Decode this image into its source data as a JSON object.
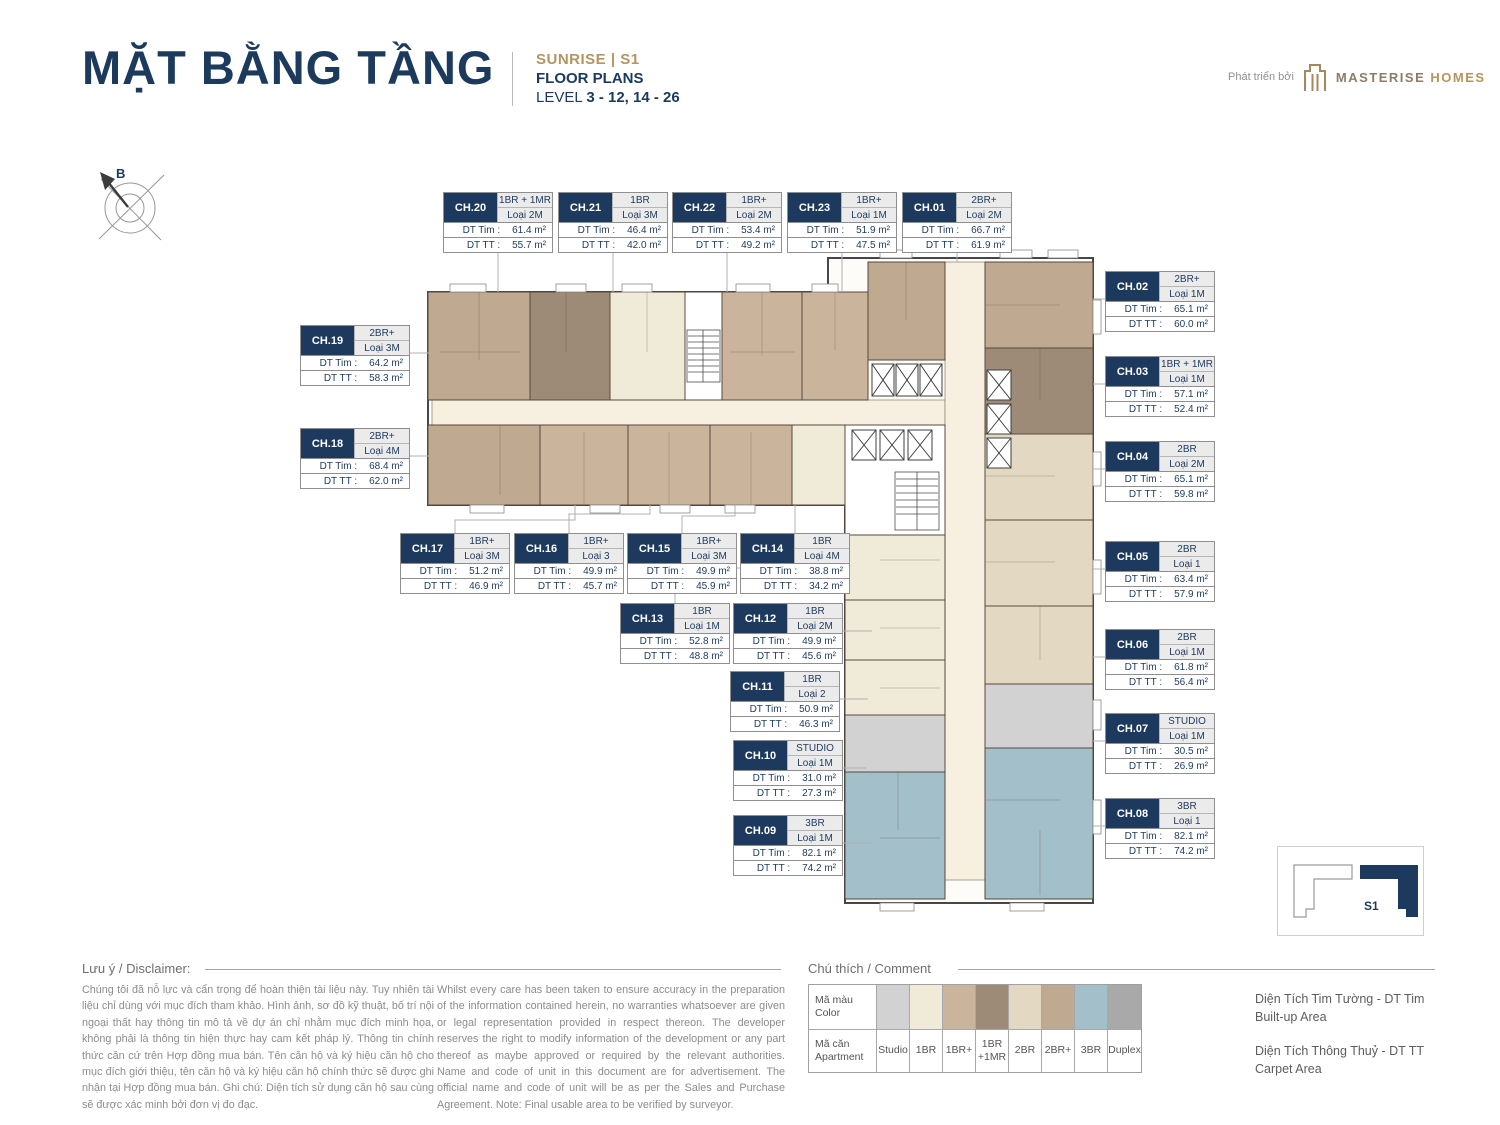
{
  "header": {
    "title": "MẶT BẰNG TẦNG",
    "project": "SUNRISE  |  S1",
    "subtitle": "FLOOR PLANS",
    "level_label": "LEVEL",
    "level_value": "3 - 12, 14 - 26",
    "developer_prefix": "Phát triển bởi",
    "developer_name": "MASTERISE",
    "developer_name2": "HOMES"
  },
  "compass_label": "B",
  "area_labels": {
    "tim": "DT Tim :",
    "tt": "DT TT :"
  },
  "units": [
    {
      "id": "CH.01",
      "type": "2BR+",
      "loai": "Loại 2M",
      "tim": "66.7 m²",
      "tt": "61.9 m²",
      "legend_key": "2BR+"
    },
    {
      "id": "CH.02",
      "type": "2BR+",
      "loai": "Loại 1M",
      "tim": "65.1 m²",
      "tt": "60.0 m²",
      "legend_key": "2BR+"
    },
    {
      "id": "CH.03",
      "type": "1BR + 1MR",
      "loai": "Loại 1M",
      "tim": "57.1 m²",
      "tt": "52.4 m²",
      "legend_key": "1BR +1MR"
    },
    {
      "id": "CH.04",
      "type": "2BR",
      "loai": "Loại 2M",
      "tim": "65.1 m²",
      "tt": "59.8 m²",
      "legend_key": "2BR"
    },
    {
      "id": "CH.05",
      "type": "2BR",
      "loai": "Loại 1",
      "tim": "63.4 m²",
      "tt": "57.9 m²",
      "legend_key": "2BR"
    },
    {
      "id": "CH.06",
      "type": "2BR",
      "loai": "Loại 1M",
      "tim": "61.8 m²",
      "tt": "56.4 m²",
      "legend_key": "2BR"
    },
    {
      "id": "CH.07",
      "type": "STUDIO",
      "loai": "Loại 1M",
      "tim": "30.5 m²",
      "tt": "26.9 m²",
      "legend_key": "Studio"
    },
    {
      "id": "CH.08",
      "type": "3BR",
      "loai": "Loại 1",
      "tim": "82.1 m²",
      "tt": "74.2 m²",
      "legend_key": "3BR"
    },
    {
      "id": "CH.09",
      "type": "3BR",
      "loai": "Loại 1M",
      "tim": "82.1 m²",
      "tt": "74.2 m²",
      "legend_key": "3BR"
    },
    {
      "id": "CH.10",
      "type": "STUDIO",
      "loai": "Loại 1M",
      "tim": "31.0 m²",
      "tt": "27.3 m²",
      "legend_key": "Studio"
    },
    {
      "id": "CH.11",
      "type": "1BR",
      "loai": "Loại 2",
      "tim": "50.9 m²",
      "tt": "46.3 m²",
      "legend_key": "1BR"
    },
    {
      "id": "CH.12",
      "type": "1BR",
      "loai": "Loại 2M",
      "tim": "49.9 m²",
      "tt": "45.6 m²",
      "legend_key": "1BR"
    },
    {
      "id": "CH.13",
      "type": "1BR",
      "loai": "Loại 1M",
      "tim": "52.8 m²",
      "tt": "48.8 m²",
      "legend_key": "1BR"
    },
    {
      "id": "CH.14",
      "type": "1BR",
      "loai": "Loại 4M",
      "tim": "38.8 m²",
      "tt": "34.2 m²",
      "legend_key": "1BR"
    },
    {
      "id": "CH.15",
      "type": "1BR+",
      "loai": "Loại 3M",
      "tim": "49.9 m²",
      "tt": "45.9 m²",
      "legend_key": "1BR+"
    },
    {
      "id": "CH.16",
      "type": "1BR+",
      "loai": "Loại 3",
      "tim": "49.9 m²",
      "tt": "45.7 m²",
      "legend_key": "1BR+"
    },
    {
      "id": "CH.17",
      "type": "1BR+",
      "loai": "Loại 3M",
      "tim": "51.2 m²",
      "tt": "46.9 m²",
      "legend_key": "1BR+"
    },
    {
      "id": "CH.18",
      "type": "2BR+",
      "loai": "Loại 4M",
      "tim": "68.4 m²",
      "tt": "62.0 m²",
      "legend_key": "2BR+"
    },
    {
      "id": "CH.19",
      "type": "2BR+",
      "loai": "Loại 3M",
      "tim": "64.2 m²",
      "tt": "58.3 m²",
      "legend_key": "2BR+"
    },
    {
      "id": "CH.20",
      "type": "1BR + 1MR",
      "loai": "Loại 2M",
      "tim": "61.4 m²",
      "tt": "55.7 m²",
      "legend_key": "1BR +1MR"
    },
    {
      "id": "CH.21",
      "type": "1BR",
      "loai": "Loại 3M",
      "tim": "46.4 m²",
      "tt": "42.0 m²",
      "legend_key": "1BR"
    },
    {
      "id": "CH.22",
      "type": "1BR+",
      "loai": "Loại 2M",
      "tim": "53.4 m²",
      "tt": "49.2 m²",
      "legend_key": "1BR+"
    },
    {
      "id": "CH.23",
      "type": "1BR+",
      "loai": "Loại 1M",
      "tim": "51.9 m²",
      "tt": "47.5 m²",
      "legend_key": "1BR+"
    }
  ],
  "legend": {
    "header": "Chú thích / Comment",
    "row1_label_vi": "Mã màu",
    "row1_label_en": "Color",
    "row2_label_vi": "Mã căn",
    "row2_label_en": "Apartment",
    "items": [
      {
        "label": "Studio",
        "color": "#d2d2d2"
      },
      {
        "label": "1BR",
        "color": "#f0ead9"
      },
      {
        "label": "1BR+",
        "color": "#cbb49c"
      },
      {
        "label": "1BR +1MR",
        "color": "#9d8b78"
      },
      {
        "label": "2BR",
        "color": "#e3d9c2"
      },
      {
        "label": "2BR+",
        "color": "#bfa991"
      },
      {
        "label": "3BR",
        "color": "#a3bfc9"
      },
      {
        "label": "Duplex",
        "color": "#a9a9a9"
      }
    ]
  },
  "disclaimer": {
    "header": "Lưu ý / Disclaimer:",
    "vi": "Chúng tôi đã nỗ lực và cẩn trọng để hoàn thiện tài liệu này. Tuy nhiên tài liệu chỉ dùng với mục đích tham khảo. Hình ảnh, sơ đồ kỹ thuật, bố trí nội ngoại thất hay thông tin mô tả về dự án chỉ nhằm mục đích minh họa, không phải là thông tin hiện thực hay cam kết pháp lý. Thông tin chính thức căn cứ trên Hợp đồng mua bán. Tên căn hộ và ký hiệu căn hộ cho mục đích giới thiệu, tên căn hộ và ký hiệu căn hộ chính thức sẽ được ghi nhận tại Hợp đồng mua bán. Ghi chú: Diện tích sử dụng căn hộ sau cùng sẽ được xác minh bởi đơn vị đo đạc.",
    "en": "Whilst every care has been taken to ensure accuracy in the preparation of the information contained herein, no warranties whatsoever are given or legal representation provided in respect thereon. The developer reserves the right to modify information of the development or any part thereof as maybe approved or required by the relevant authorities. Name and code of unit in this document are for advertisement. The official name and code of unit will be as per the Sales and Purchase Agreement. Note: Final usable area to be verified by surveyor."
  },
  "area_notes": [
    {
      "vi": "Diện Tích Tim Tường - DT Tim",
      "en": "Built-up Area"
    },
    {
      "vi": "Diện Tích Thông Thuỷ - DT TT",
      "en": "Carpet Area"
    }
  ],
  "keyplan_label": "S1",
  "colors": {
    "navy": "#1d3a5e",
    "gold": "#b5955f",
    "corridor": "#f7f0e0"
  }
}
